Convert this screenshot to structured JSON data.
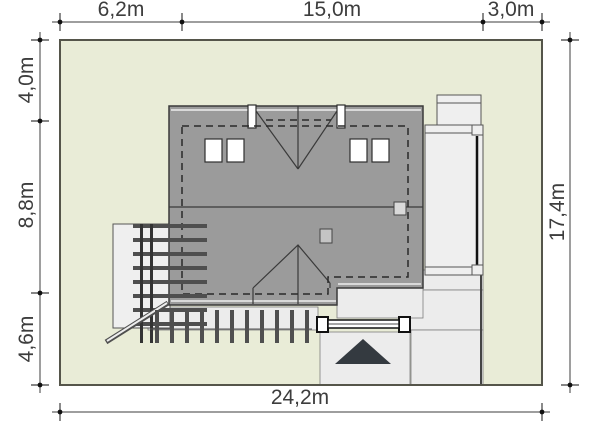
{
  "title": "house-plot-site-plan",
  "colors": {
    "plot_fill": "#e9ecd7",
    "plot_border": "#55554a",
    "roof_fill": "#9b9b9b",
    "roof_line": "#3a3a3a",
    "light_fill": "#efefef",
    "paving_fill": "#ececec",
    "pergola_bar": "#4f4f4f",
    "arrow_fill": "#343a40",
    "dim_color": "#3d3d3d"
  },
  "dimensions": {
    "top": [
      {
        "label": "6,2m"
      },
      {
        "label": "15,0m"
      },
      {
        "label": "3,0m"
      }
    ],
    "left": [
      {
        "label": "4,0m"
      },
      {
        "label": "8,8m"
      },
      {
        "label": "4,6m"
      }
    ],
    "right": [
      {
        "label": "17,4m"
      }
    ],
    "bottom": [
      {
        "label": "24,2m"
      }
    ]
  }
}
